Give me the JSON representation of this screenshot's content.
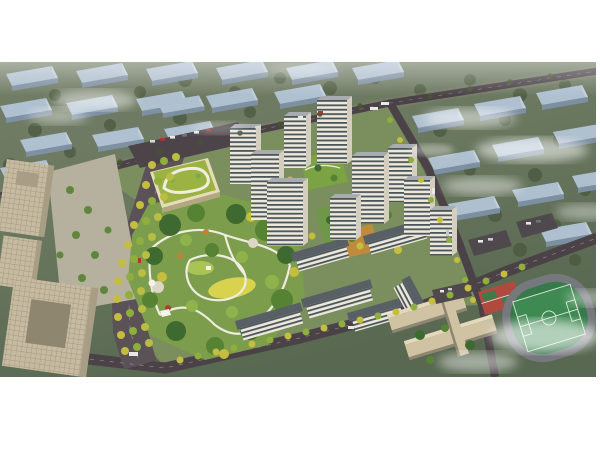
{
  "window": {
    "title": "aerial-masterplan-rendering",
    "description": "Bird's-eye architectural rendering of a residential masterplan: white high-rise towers around green courtyards, a large landscaped park with winding paths, a kindergarten with a green roof, beige office blocks at left, a school campus and running-track sports field at lower right, tree-lined boulevards, hazy rows of context housing slabs and drifting clouds.",
    "visible_text": []
  },
  "palette": {
    "margin": "#ffffff",
    "ground": "#6b7860",
    "ground_dark": "#586851",
    "parcel": "#7a8f5d",
    "road": "#4a4247",
    "context_roof": "#b3c4d6",
    "context_side": "#7f92a7",
    "tower_face": "#ece8da",
    "tower_window": "#4b555c",
    "tower_roof": "#a8acaf",
    "office_beige": "#c6bba1",
    "kindergarten_roof": "#9cb343",
    "park_green": "#7c9d4c",
    "tree_dark": "#3e6a2f",
    "tree_yellow": "#c4bd40",
    "lawn_yellow": "#d8d24e",
    "path_white": "#efece0",
    "sports_pitch": "#3f8a52",
    "court_red": "#b04a3e",
    "fog_white": "#ffffff"
  },
  "scene": {
    "regions": [
      {
        "name": "context-housing-north",
        "kind": "hazy low-rise slab rows"
      },
      {
        "name": "context-housing-east",
        "kind": "hazy low-rise slab rows with fog"
      },
      {
        "name": "office-campus-west",
        "kind": "beige office buildings and plaza"
      },
      {
        "name": "kindergarten",
        "kind": "green-roof school with white loop"
      },
      {
        "name": "central-park",
        "kind": "trees, lawns, winding white paths, pavilions"
      },
      {
        "name": "tower-cluster",
        "kind": "white residential high-rises with window bands"
      },
      {
        "name": "midrise-slabs",
        "kind": "white mid-rise slabs with dark roofs"
      },
      {
        "name": "school-campus",
        "kind": "beige linked teaching bars with red courts"
      },
      {
        "name": "sports-field",
        "kind": "green pitch with running track"
      },
      {
        "name": "boulevard-west",
        "kind": "tree-lined avenue with yellow trees"
      },
      {
        "name": "perimeter-roads",
        "kind": "dark asphalt roads with vehicles"
      },
      {
        "name": "clouds",
        "kind": "white fog wisps"
      }
    ]
  }
}
